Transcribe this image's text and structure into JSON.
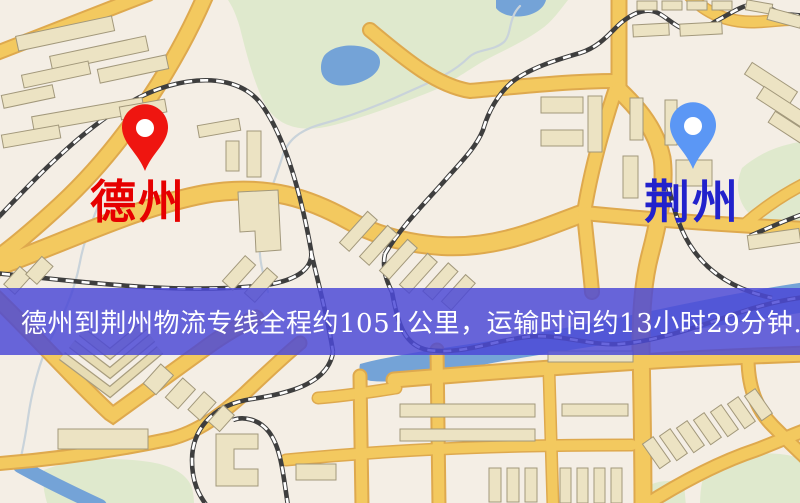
{
  "banner": {
    "text": "德州到荆州物流专线全程约1051公里，运输时间约13小时29分钟.",
    "background": "#4b49d6",
    "text_color": "#ffffff"
  },
  "markers": {
    "origin": {
      "name": "德州",
      "label_color": "#e60000",
      "pin_color": "#ef1510",
      "icon": "map-pin"
    },
    "destination": {
      "name": "荆州",
      "label_color": "#2222cc",
      "pin_color": "#5b97f5",
      "icon": "map-pin"
    }
  },
  "route": {
    "origin": "德州",
    "destination": "荆州",
    "distance_text": "约1051公里",
    "duration_text": "约13小时29分钟"
  },
  "map_colors": {
    "background": "#f4eee5",
    "road_fill": "#f3c95f",
    "road_edge": "#dea94e",
    "building_fill": "#ece3c3",
    "building_edge": "#a2987b",
    "park_green": "#dfe9cd",
    "water_blue": "#74a3d7",
    "railway_dark": "#3e3e3e",
    "railway_dash": "#ffffff",
    "stream": "#c9d3da"
  }
}
